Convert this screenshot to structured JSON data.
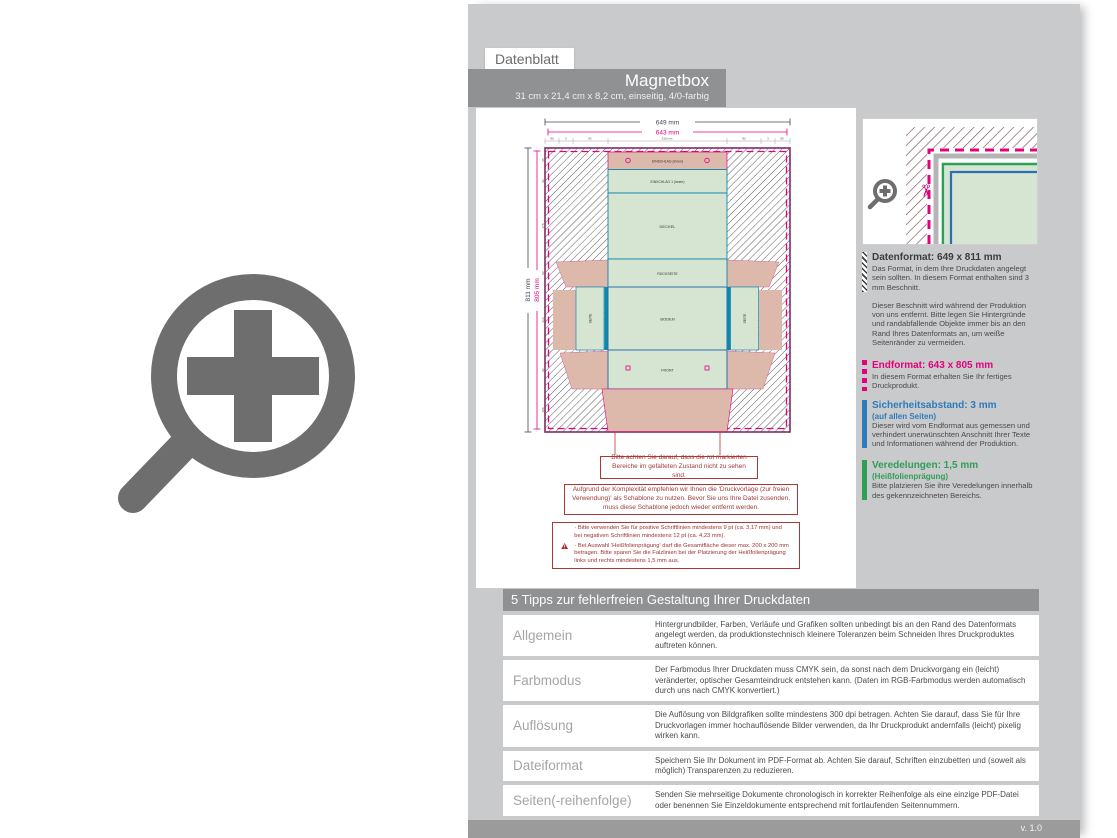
{
  "header": {
    "tab": "Datenblatt",
    "title": "Magnetbox",
    "subtitle": "31 cm x 21,4 cm x 8,2 cm, einseitig, 4/0-farbig"
  },
  "drawing": {
    "dims": {
      "top_outer": "649 mm",
      "top_inner": "643 mm",
      "left_outer": "811 mm",
      "left_inner": "805 mm"
    },
    "top_segments": [
      "80",
      "3",
      "82",
      "310 mm",
      "82",
      "3",
      "80"
    ],
    "left_segments": [
      "55",
      "82",
      "178",
      "82",
      "214",
      "82",
      "108"
    ],
    "panel_labels": {
      "top_flap": "EINSCHLAG (innen)",
      "top_flap2": "EINSCHLAG 1 (innen)",
      "lid": "DECKEL",
      "back": "RÜCKSEITE",
      "bottom": "BODEN",
      "side_left": "SEITE",
      "side_right": "SEITE",
      "front": "FRONT"
    },
    "notes": [
      "Bitte achten Sie darauf, dass die rot markierten Bereiche im gefalteten Zustand nicht zu sehen sind.",
      "Aufgrund der Komplexität empfehlen wir Ihnen die 'Druckvorlage (zur freien Verwendung)' als Schablone zu nutzen. Bevor Sie uns Ihre Datei zusenden, muss diese Schablone jedoch wieder entfernt werden."
    ],
    "warning_bullets": [
      "· Bitte verwenden Sie für positive Schriftlinien mindestens 9 pt (ca. 3,17 mm) und bei negativen Schriftlinien mindestens 12 pt (ca. 4,23 mm).",
      "· Bei Auswahl 'Heißfolienprägung' darf die Gesamtfläche dieser max. 200 x 200 mm betragen. Bitte sparen Sie die Falzlinien bei der Platzierung der Heißfolienprägung links und rechts mindestens 1,5 mm aus."
    ]
  },
  "info": {
    "datenformat_title": "Datenformat: 649 x 811 mm",
    "datenformat_body": "Das Format, in dem Ihre Druckdaten angelegt sein sollten. In diesem Format enthalten sind 3 mm Beschnitt.",
    "beschnitt_body": "Dieser Beschnitt wird während der Produktion von uns entfernt. Bitte legen Sie Hintergründe und randabfallende Objekte immer bis an den Rand Ihres Datenformats an, um weiße Seitenränder zu vermeiden.",
    "endformat_title": "Endformat: 643 x 805 mm",
    "endformat_body": "In diesem Format erhalten Sie Ihr fertiges Druckprodukt.",
    "sicherheit_title": "Sicherheitsabstand: 3 mm",
    "sicherheit_sub": "(auf allen Seiten)",
    "sicherheit_body": "Dieser wird vom Endformat aus gemessen und verhindert unerwünschten Anschnitt Ihrer Texte und Informationen während der Produktion.",
    "veredelung_title": "Veredelungen: 1,5 mm",
    "veredelung_sub": "(Heißfolienprägung)",
    "veredelung_body": "Bitte platzieren Sie ihre Veredelungen innerhalb des gekennzeichneten Bereichs."
  },
  "tips": {
    "header": "5 Tipps zur fehlerfreien Gestaltung Ihrer Druckdaten",
    "rows": [
      {
        "label": "Allgemein",
        "text": "Hintergrundbilder, Farben, Verläufe und Grafiken sollten unbedingt bis an den Rand des Datenformats angelegt werden, da produktionstechnisch kleinere Toleranzen beim Schneiden Ihres Druckproduktes auftreten können."
      },
      {
        "label": "Farbmodus",
        "text": "Der Farbmodus Ihrer Druckdaten muss CMYK sein, da sonst nach dem Druckvorgang ein (leicht) veränderter, optischer Gesamteindruck entstehen kann. (Daten im RGB-Farbmodus werden automatisch durch uns nach CMYK konvertiert.)"
      },
      {
        "label": "Auflösung",
        "text": "Die Auflösung von Bildgrafiken sollte mindestens 300 dpi betragen. Achten Sie darauf, dass Sie für Ihre Druckvorlagen immer hochauflösende Bilder verwenden, da Ihr Druckprodukt andernfalls (leicht) pixelig wirken kann."
      },
      {
        "label": "Dateiformat",
        "text": "Speichern Sie Ihr Dokument im PDF-Format ab. Achten Sie darauf, Schriften einzubetten und (soweit als möglich) Transparenzen zu reduzieren."
      },
      {
        "label": "Seiten(-reihenfolge)",
        "text": "Senden Sie mehrseitige Dokumente chronologisch in korrekter Reihenfolge als eine einzige PDF-Datei oder benennen Sie Einzeldokumente entsprechend mit fortlaufenden Seitennummern."
      }
    ]
  },
  "footer": {
    "version": "v. 1.0"
  },
  "colors": {
    "magenta": "#e5007d",
    "blue": "#2e7bbd",
    "green": "#2f9e57",
    "teal": "#0f87ad",
    "purple": "#7c2d62",
    "bar_gray": "#8f9193",
    "sheet_gray": "#c9cacb",
    "fill_green": "#d6e5d2",
    "fill_salmon": "#dcb9ab"
  }
}
